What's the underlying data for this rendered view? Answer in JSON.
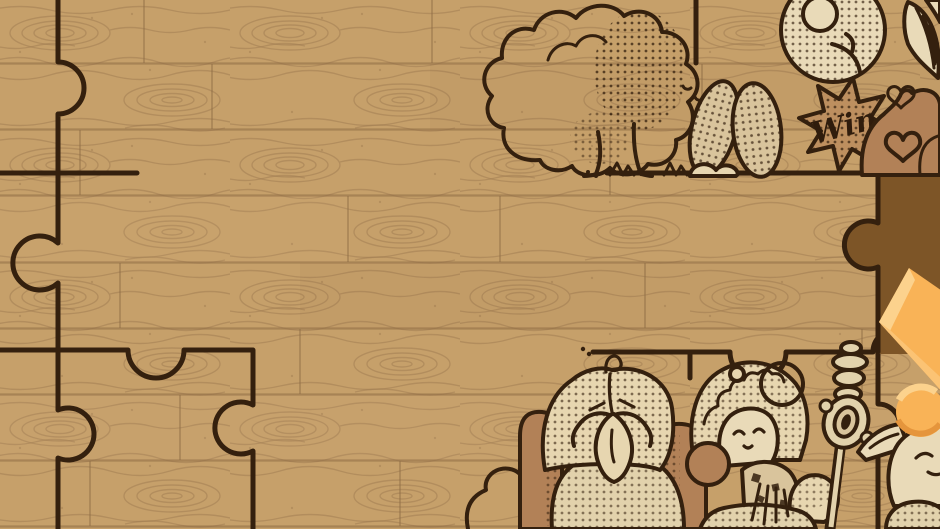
{
  "app": {
    "name": "jigsaw-puzzle-game",
    "scene": "wood-plank puzzle board, partially assembled"
  },
  "labels": {
    "win": "Win"
  },
  "colors": {
    "wood_base": "#c6a06a",
    "wood_grain": "#a27d52",
    "plank_seam": "#8e6c44",
    "sketch_outline": "#34200e",
    "cream_fill": "#e7d6b0",
    "mid_brown_fill": "#b28157",
    "hole_brown": "#7d5527",
    "piece_orange": "#f9b357",
    "piece_orange_light": "#fcd28d",
    "piece_orange_shade": "#e5953c"
  },
  "board": {
    "missing_piece_region": "right-center dark brown hole with knob edges",
    "loose_piece": "orange rotated puzzle piece entering from right edge",
    "artwork_elements": [
      "tree",
      "grass-tufts",
      "rabbit-ears",
      "chick-balloon",
      "win-burst",
      "squirrel",
      "hearts",
      "leaf",
      "bush",
      "old-man",
      "gnome-lady",
      "staff",
      "elf"
    ]
  }
}
